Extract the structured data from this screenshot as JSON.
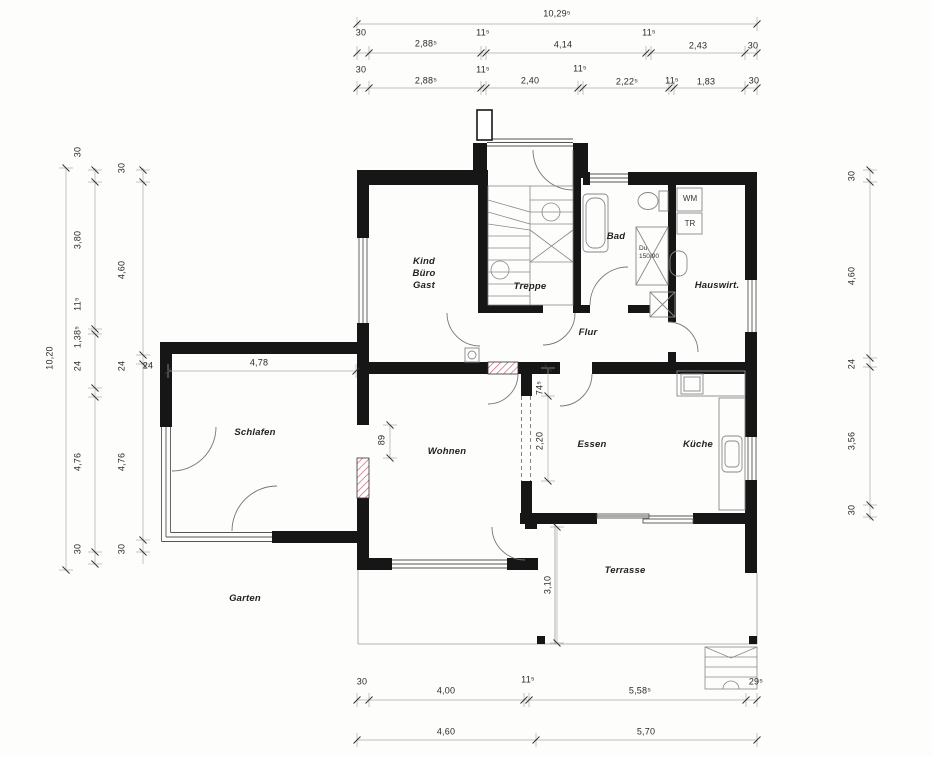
{
  "drawing": {
    "type": "architectural floor plan",
    "wall_color": "#161616",
    "hatch_color": "#c4637a"
  },
  "rooms": [
    {
      "name": "room-label-kind-buero-gast",
      "label": "Kind\nBüro\nGast",
      "x": 424,
      "y": 274
    },
    {
      "name": "room-label-treppe",
      "label": "Treppe",
      "x": 530,
      "y": 287
    },
    {
      "name": "room-label-bad",
      "label": "Bad",
      "x": 616,
      "y": 237
    },
    {
      "name": "room-label-hauswirt",
      "label": "Hauswirt.",
      "x": 717,
      "y": 286
    },
    {
      "name": "room-label-flur",
      "label": "Flur",
      "x": 588,
      "y": 333
    },
    {
      "name": "room-label-schlafen",
      "label": "Schlafen",
      "x": 255,
      "y": 433
    },
    {
      "name": "room-label-wohnen",
      "label": "Wohnen",
      "x": 447,
      "y": 452
    },
    {
      "name": "room-label-essen",
      "label": "Essen",
      "x": 592,
      "y": 445
    },
    {
      "name": "room-label-kueche",
      "label": "Küche",
      "x": 698,
      "y": 445
    },
    {
      "name": "room-label-terrasse",
      "label": "Terrasse",
      "x": 625,
      "y": 571
    },
    {
      "name": "room-label-garten",
      "label": "Garten",
      "x": 245,
      "y": 599
    }
  ],
  "fixtures": [
    {
      "name": "washing-machine-label",
      "label": "WM",
      "x": 690,
      "y": 199,
      "small": false
    },
    {
      "name": "dryer-label",
      "label": "TR",
      "x": 690,
      "y": 224,
      "small": false
    },
    {
      "name": "shower-label",
      "label": "Du\n150/90",
      "x": 649,
      "y": 253,
      "small": true
    }
  ],
  "dimensions": {
    "horizontal": [
      {
        "name": "dim-total-width",
        "text": "10,29⁵",
        "x": 557,
        "y": 14
      },
      {
        "name": "dim-top2-30a",
        "text": "30",
        "x": 361,
        "y": 33
      },
      {
        "name": "dim-top2-2885",
        "text": "2,88⁵",
        "x": 426,
        "y": 44
      },
      {
        "name": "dim-top2-115a",
        "text": "11⁵",
        "x": 483,
        "y": 33
      },
      {
        "name": "dim-top2-414",
        "text": "4,14",
        "x": 563,
        "y": 45
      },
      {
        "name": "dim-top2-115b",
        "text": "11⁵",
        "x": 649,
        "y": 33
      },
      {
        "name": "dim-top2-243",
        "text": "2,43",
        "x": 698,
        "y": 46
      },
      {
        "name": "dim-top2-30b",
        "text": "30",
        "x": 753,
        "y": 46
      },
      {
        "name": "dim-top3-30a",
        "text": "30",
        "x": 361,
        "y": 70
      },
      {
        "name": "dim-top3-2885",
        "text": "2,88⁵",
        "x": 426,
        "y": 81
      },
      {
        "name": "dim-top3-115a",
        "text": "11⁵",
        "x": 483,
        "y": 70
      },
      {
        "name": "dim-top3-240",
        "text": "2,40",
        "x": 530,
        "y": 81
      },
      {
        "name": "dim-top3-115b",
        "text": "11⁵",
        "x": 580,
        "y": 69
      },
      {
        "name": "dim-top3-2225",
        "text": "2,22⁵",
        "x": 627,
        "y": 82
      },
      {
        "name": "dim-top3-115c",
        "text": "11⁵",
        "x": 672,
        "y": 81
      },
      {
        "name": "dim-top3-183",
        "text": "1,83",
        "x": 706,
        "y": 82
      },
      {
        "name": "dim-top3-30b",
        "text": "30",
        "x": 754,
        "y": 81
      },
      {
        "name": "dim-bot1-30",
        "text": "30",
        "x": 362,
        "y": 682
      },
      {
        "name": "dim-bot1-400",
        "text": "4,00",
        "x": 446,
        "y": 691
      },
      {
        "name": "dim-bot1-115",
        "text": "11⁵",
        "x": 528,
        "y": 680
      },
      {
        "name": "dim-bot1-5585",
        "text": "5,58⁵",
        "x": 640,
        "y": 691
      },
      {
        "name": "dim-bot1-295",
        "text": "29⁵",
        "x": 756,
        "y": 682
      },
      {
        "name": "dim-bot2-460",
        "text": "4,60",
        "x": 446,
        "y": 732
      },
      {
        "name": "dim-bot2-570",
        "text": "5,70",
        "x": 646,
        "y": 732
      },
      {
        "name": "dim-schlafen-478",
        "text": "4,78",
        "x": 259,
        "y": 363
      },
      {
        "name": "dim-schlafen-24",
        "text": "24",
        "x": 148,
        "y": 366
      }
    ],
    "vertical": [
      {
        "name": "dim-total-height",
        "text": "10,20",
        "x": 50,
        "y": 358
      },
      {
        "name": "dim-left2-30a",
        "text": "30",
        "x": 78,
        "y": 152
      },
      {
        "name": "dim-left2-380",
        "text": "3,80",
        "x": 78,
        "y": 240
      },
      {
        "name": "dim-left2-115",
        "text": "11⁵",
        "x": 78,
        "y": 304
      },
      {
        "name": "dim-left2-1385",
        "text": "1,38⁵",
        "x": 78,
        "y": 337
      },
      {
        "name": "dim-left2-24",
        "text": "24",
        "x": 78,
        "y": 366
      },
      {
        "name": "dim-left2-476",
        "text": "4,76",
        "x": 78,
        "y": 462
      },
      {
        "name": "dim-left2-30b",
        "text": "30",
        "x": 78,
        "y": 549
      },
      {
        "name": "dim-left3-30a",
        "text": "30",
        "x": 122,
        "y": 168
      },
      {
        "name": "dim-left3-460",
        "text": "4,60",
        "x": 122,
        "y": 270
      },
      {
        "name": "dim-left3-24",
        "text": "24",
        "x": 122,
        "y": 366
      },
      {
        "name": "dim-left3-476",
        "text": "4,76",
        "x": 122,
        "y": 462
      },
      {
        "name": "dim-left3-30b",
        "text": "30",
        "x": 122,
        "y": 549
      },
      {
        "name": "dim-right-30a",
        "text": "30",
        "x": 852,
        "y": 176
      },
      {
        "name": "dim-right-460",
        "text": "4,60",
        "x": 852,
        "y": 276
      },
      {
        "name": "dim-right-24",
        "text": "24",
        "x": 852,
        "y": 364
      },
      {
        "name": "dim-right-356",
        "text": "3,56",
        "x": 852,
        "y": 441
      },
      {
        "name": "dim-right-30b",
        "text": "30",
        "x": 852,
        "y": 510
      },
      {
        "name": "dim-opening-89",
        "text": "89",
        "x": 382,
        "y": 440
      },
      {
        "name": "dim-opening-745",
        "text": "74⁵",
        "x": 540,
        "y": 388
      },
      {
        "name": "dim-opening-220",
        "text": "2,20",
        "x": 540,
        "y": 441
      },
      {
        "name": "dim-terrace-310",
        "text": "3,10",
        "x": 548,
        "y": 585
      }
    ]
  }
}
